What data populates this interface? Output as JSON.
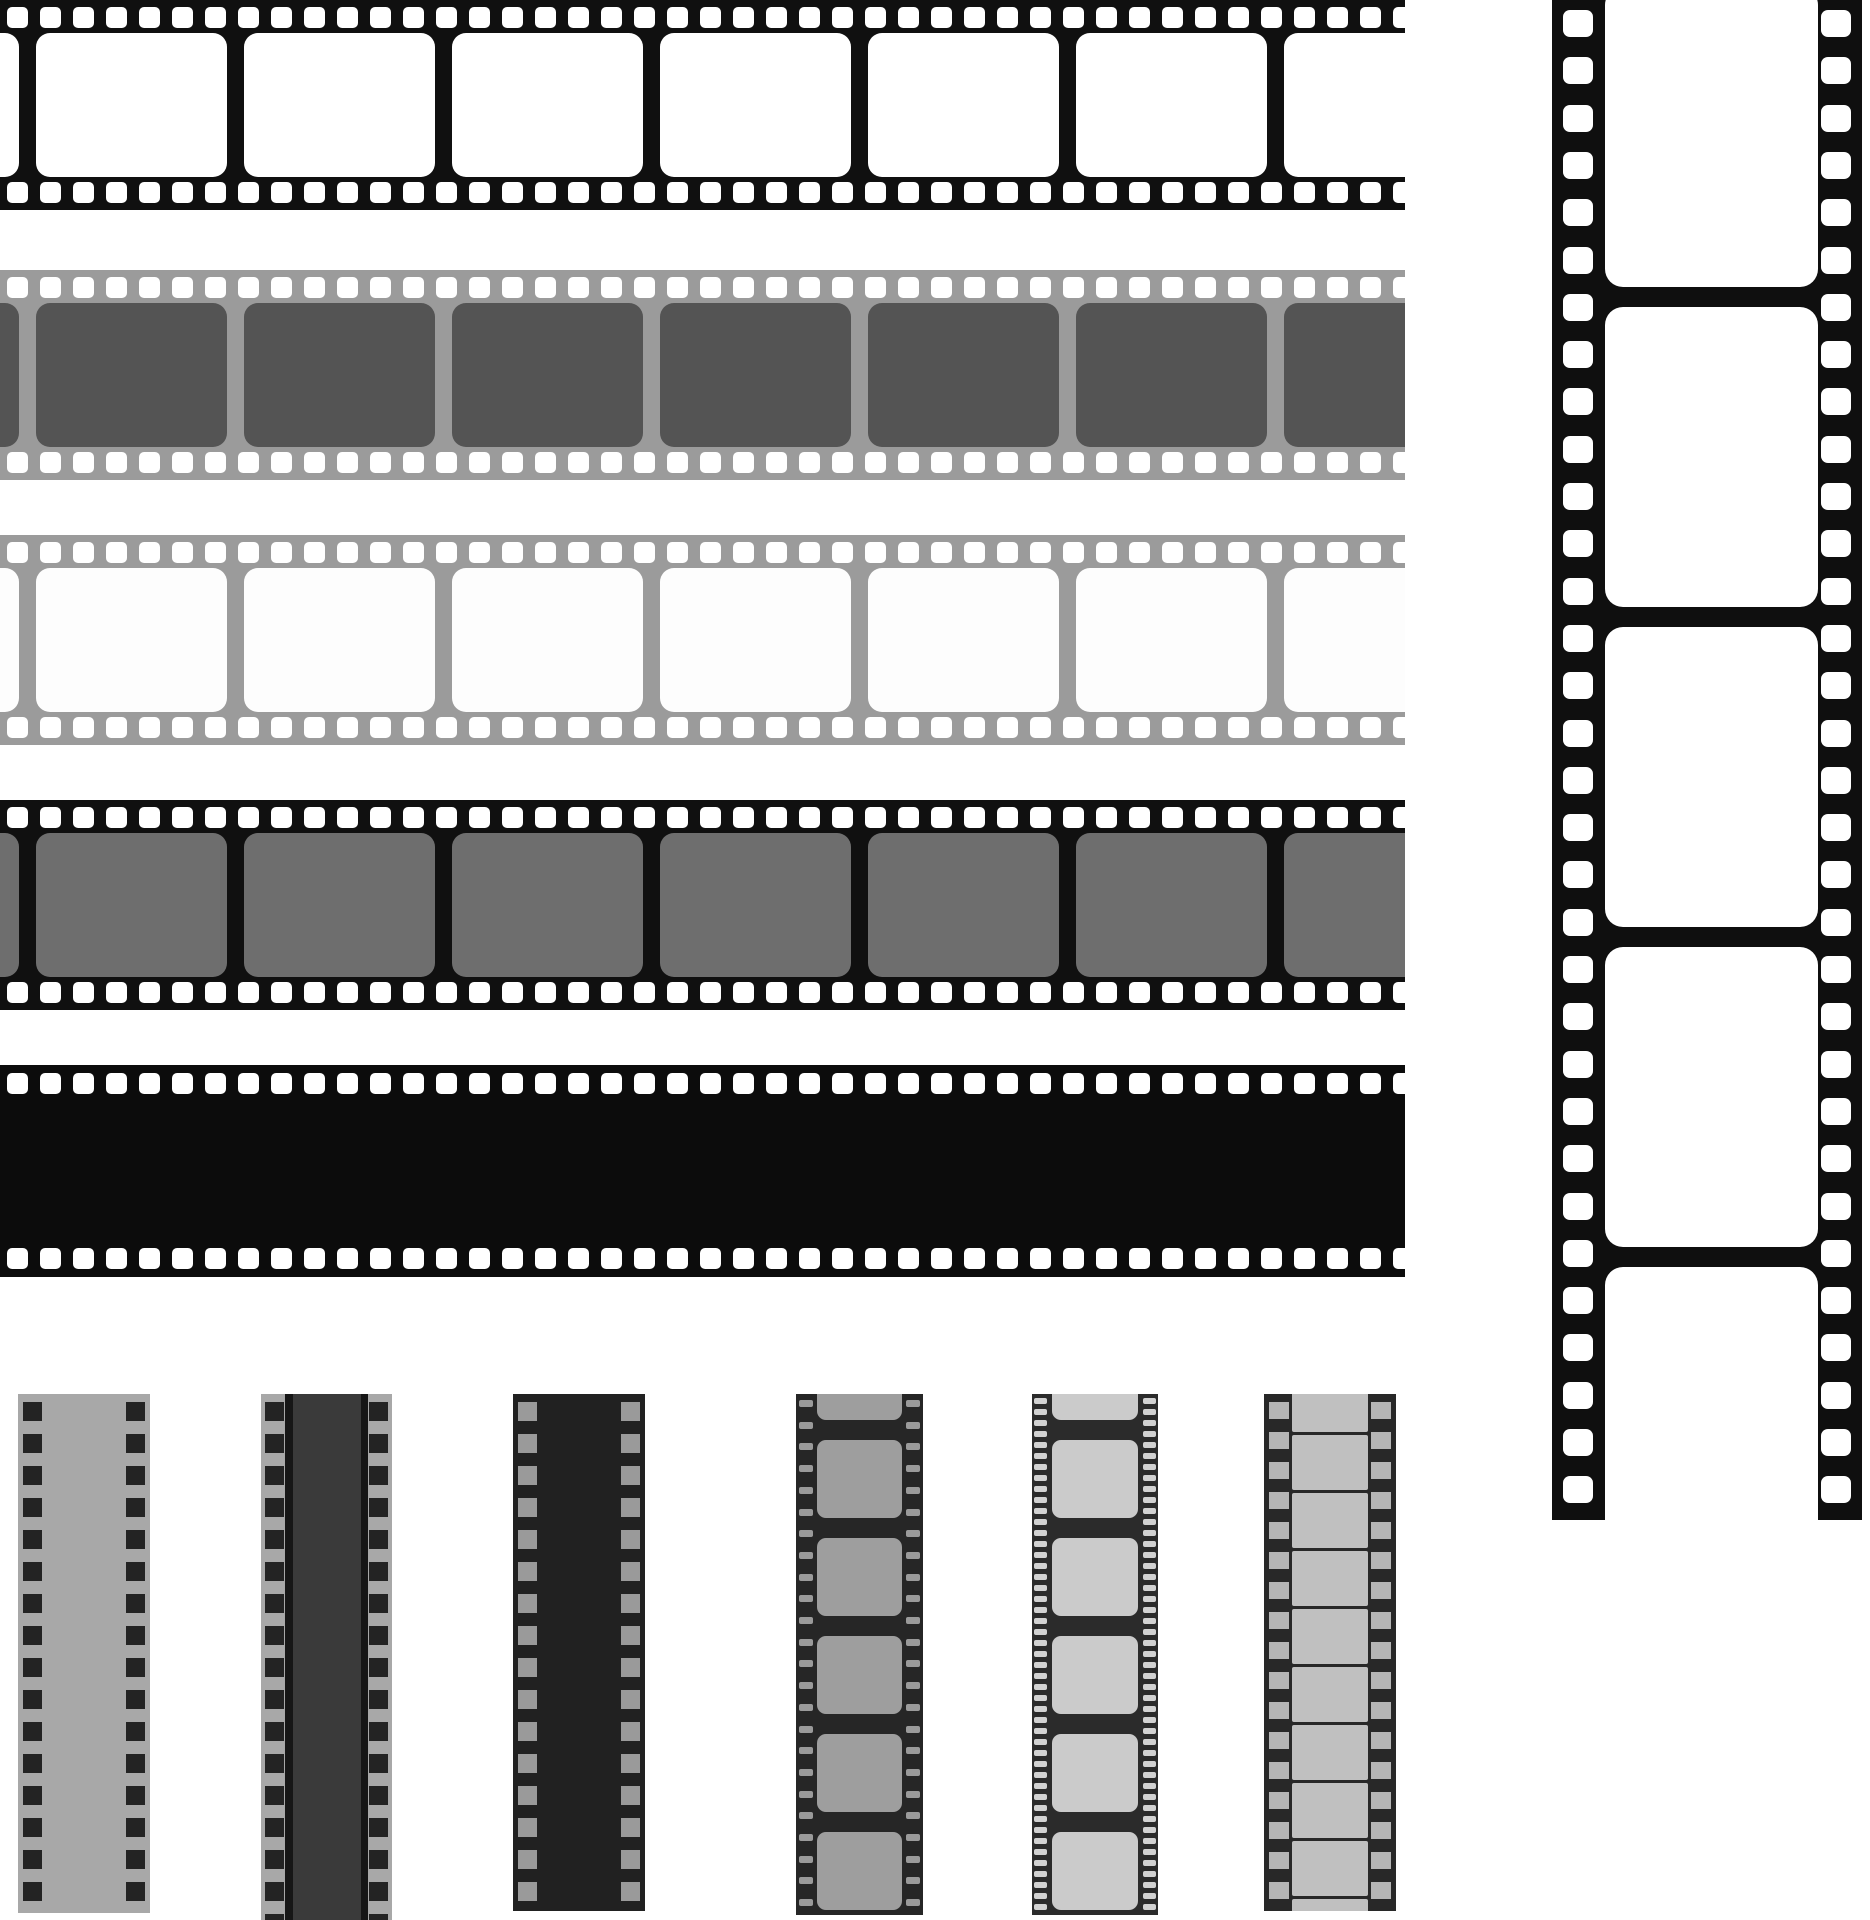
{
  "canvas": {
    "width": 1870,
    "height": 1920,
    "background": "#ffffff"
  },
  "illustration_title": "film-strips-set",
  "palette": {
    "black_strip": "#101010",
    "gray_strip": "#9b9b9b",
    "dark_frame": "#545454",
    "mid_frame": "#6e6e6e",
    "white": "#ffffff",
    "small_dark_bg": "#262626",
    "small_gray_bg": "#a8a8a8",
    "light_frame": "#cbcbcb"
  },
  "strips": {
    "horizontal": [
      {
        "x": 0,
        "y": 0,
        "w": 1405,
        "h": 210,
        "bg": "#101010",
        "perfs": [
          {
            "axis": "x",
            "count": 43,
            "start": 7,
            "pitch": 33,
            "cross": 7,
            "w": 21,
            "h": 21,
            "r": 5,
            "color": "#ffffff"
          },
          {
            "axis": "x",
            "count": 43,
            "start": 7,
            "pitch": 33,
            "cross": 182,
            "w": 21,
            "h": 21,
            "r": 5,
            "color": "#ffffff"
          }
        ],
        "frames": [
          {
            "axis": "x",
            "count": 8,
            "start": -172,
            "pitch": 208,
            "cross": 33,
            "w": 191,
            "h": 144,
            "r": 14,
            "color": "#ffffff"
          }
        ]
      },
      {
        "x": 0,
        "y": 270,
        "w": 1405,
        "h": 210,
        "bg": "#9b9b9b",
        "perfs": [
          {
            "axis": "x",
            "count": 43,
            "start": 7,
            "pitch": 33,
            "cross": 7,
            "w": 21,
            "h": 21,
            "r": 5,
            "color": "#ffffff"
          },
          {
            "axis": "x",
            "count": 43,
            "start": 7,
            "pitch": 33,
            "cross": 182,
            "w": 21,
            "h": 21,
            "r": 5,
            "color": "#ffffff"
          }
        ],
        "frames": [
          {
            "axis": "x",
            "count": 8,
            "start": -172,
            "pitch": 208,
            "cross": 33,
            "w": 191,
            "h": 144,
            "r": 14,
            "color": "#545454"
          }
        ]
      },
      {
        "x": 0,
        "y": 535,
        "w": 1405,
        "h": 210,
        "bg": "#9b9b9b",
        "perfs": [
          {
            "axis": "x",
            "count": 43,
            "start": 7,
            "pitch": 33,
            "cross": 7,
            "w": 21,
            "h": 21,
            "r": 5,
            "color": "#ffffff"
          },
          {
            "axis": "x",
            "count": 43,
            "start": 7,
            "pitch": 33,
            "cross": 182,
            "w": 21,
            "h": 21,
            "r": 5,
            "color": "#ffffff"
          }
        ],
        "frames": [
          {
            "axis": "x",
            "count": 8,
            "start": -172,
            "pitch": 208,
            "cross": 33,
            "w": 191,
            "h": 144,
            "r": 14,
            "color": "#fdfdfd"
          }
        ]
      },
      {
        "x": 0,
        "y": 800,
        "w": 1405,
        "h": 210,
        "bg": "#101010",
        "perfs": [
          {
            "axis": "x",
            "count": 43,
            "start": 7,
            "pitch": 33,
            "cross": 7,
            "w": 21,
            "h": 21,
            "r": 5,
            "color": "#ffffff"
          },
          {
            "axis": "x",
            "count": 43,
            "start": 7,
            "pitch": 33,
            "cross": 182,
            "w": 21,
            "h": 21,
            "r": 5,
            "color": "#ffffff"
          }
        ],
        "frames": [
          {
            "axis": "x",
            "count": 8,
            "start": -172,
            "pitch": 208,
            "cross": 33,
            "w": 191,
            "h": 144,
            "r": 14,
            "color": "#6e6e6e"
          }
        ]
      },
      {
        "x": 0,
        "y": 1065,
        "w": 1405,
        "h": 212,
        "bg": "#0c0c0c",
        "perfs": [
          {
            "axis": "x",
            "count": 43,
            "start": 7,
            "pitch": 33,
            "cross": 8,
            "w": 21,
            "h": 21,
            "r": 5,
            "color": "#ffffff"
          },
          {
            "axis": "x",
            "count": 43,
            "start": 7,
            "pitch": 33,
            "cross": 183,
            "w": 21,
            "h": 21,
            "r": 5,
            "color": "#ffffff"
          }
        ]
      }
    ],
    "vertical": {
      "x": 1552,
      "y": 0,
      "w": 310,
      "h": 1520,
      "bg": "#0f0f0f",
      "perfs": [
        {
          "axis": "y",
          "count": 32,
          "start": 10,
          "pitch": 47.3,
          "cross": 11,
          "w": 30,
          "h": 27,
          "r": 7,
          "color": "#ffffff"
        },
        {
          "axis": "y",
          "count": 32,
          "start": 10,
          "pitch": 47.3,
          "cross": 269,
          "w": 30,
          "h": 27,
          "r": 7,
          "color": "#ffffff"
        }
      ],
      "frames": [
        {
          "axis": "y",
          "count": 5,
          "start": -13,
          "pitch": 320,
          "cross": 53,
          "w": 213,
          "h": 300,
          "r": 18,
          "color": "#ffffff"
        }
      ]
    },
    "small": [
      {
        "x": 18,
        "y": 1394,
        "w": 132,
        "h": 519,
        "bg": "#a8a8a8",
        "perfs": [
          {
            "axis": "y",
            "count": 16,
            "start": 8,
            "pitch": 32,
            "cross": 5,
            "w": 19,
            "h": 19,
            "r": 0,
            "color": "#232323"
          },
          {
            "axis": "y",
            "count": 16,
            "start": 8,
            "pitch": 32,
            "cross": 108,
            "w": 19,
            "h": 19,
            "r": 0,
            "color": "#232323"
          }
        ]
      },
      {
        "x": 261,
        "y": 1394,
        "w": 131,
        "h": 526,
        "bg": "#a8a8a8",
        "perfs": [
          {
            "axis": "y",
            "count": 17,
            "start": 8,
            "pitch": 32,
            "cross": 4,
            "w": 19,
            "h": 19,
            "r": 0,
            "color": "#232323"
          },
          {
            "axis": "y",
            "count": 17,
            "start": 8,
            "pitch": 32,
            "cross": 108,
            "w": 19,
            "h": 19,
            "r": 0,
            "color": "#232323"
          }
        ],
        "bands": [
          {
            "x": 24,
            "w": 8,
            "color": "#161616"
          },
          {
            "x": 32,
            "w": 68,
            "color": "#3a3a3a"
          },
          {
            "x": 100,
            "w": 7,
            "color": "#161616"
          }
        ]
      },
      {
        "x": 513,
        "y": 1394,
        "w": 132,
        "h": 517,
        "bg": "#212121",
        "perfs": [
          {
            "axis": "y",
            "count": 16,
            "start": 8,
            "pitch": 32,
            "cross": 5,
            "w": 19,
            "h": 19,
            "r": 0,
            "color": "#9a9a9a"
          },
          {
            "axis": "y",
            "count": 16,
            "start": 8,
            "pitch": 32,
            "cross": 108,
            "w": 19,
            "h": 19,
            "r": 0,
            "color": "#9a9a9a"
          }
        ]
      },
      {
        "x": 796,
        "y": 1394,
        "w": 127,
        "h": 521,
        "bg": "#262626",
        "perfs": [
          {
            "axis": "y",
            "count": 24,
            "start": 6,
            "pitch": 21.7,
            "cross": 3,
            "w": 14,
            "h": 7,
            "r": 2,
            "color": "#9a9a9a"
          },
          {
            "axis": "y",
            "count": 24,
            "start": 6,
            "pitch": 21.7,
            "cross": 110,
            "w": 14,
            "h": 7,
            "r": 2,
            "color": "#9a9a9a"
          }
        ],
        "frames": [
          {
            "axis": "y",
            "count": 6,
            "start": -52,
            "pitch": 98,
            "cross": 21,
            "w": 85,
            "h": 78,
            "r": 9,
            "color": "#9e9e9e"
          }
        ]
      },
      {
        "x": 1032,
        "y": 1394,
        "w": 126,
        "h": 521,
        "bg": "#2b2b2b",
        "perfs": [
          {
            "axis": "y",
            "count": 47,
            "start": 4,
            "pitch": 11,
            "cross": 2,
            "w": 13,
            "h": 6,
            "r": 2,
            "color": "#d2d2d2"
          },
          {
            "axis": "y",
            "count": 47,
            "start": 4,
            "pitch": 11,
            "cross": 111,
            "w": 13,
            "h": 6,
            "r": 2,
            "color": "#d2d2d2"
          }
        ],
        "frames": [
          {
            "axis": "y",
            "count": 6,
            "start": -52,
            "pitch": 98,
            "cross": 20,
            "w": 86,
            "h": 78,
            "r": 9,
            "color": "#cbcbcb"
          }
        ]
      },
      {
        "x": 1264,
        "y": 1394,
        "w": 132,
        "h": 517,
        "bg": "#282828",
        "perfs": [
          {
            "axis": "y",
            "count": 17,
            "start": 8,
            "pitch": 30,
            "cross": 5,
            "w": 20,
            "h": 17,
            "r": 0,
            "color": "#b5b5b5"
          },
          {
            "axis": "y",
            "count": 17,
            "start": 8,
            "pitch": 30,
            "cross": 107,
            "w": 20,
            "h": 17,
            "r": 0,
            "color": "#b5b5b5"
          }
        ],
        "frames": [
          {
            "axis": "y",
            "count": 10,
            "start": -17,
            "pitch": 58,
            "cross": 28,
            "w": 76,
            "h": 55,
            "r": 2,
            "color": "#c0c0c0"
          }
        ]
      }
    ]
  }
}
